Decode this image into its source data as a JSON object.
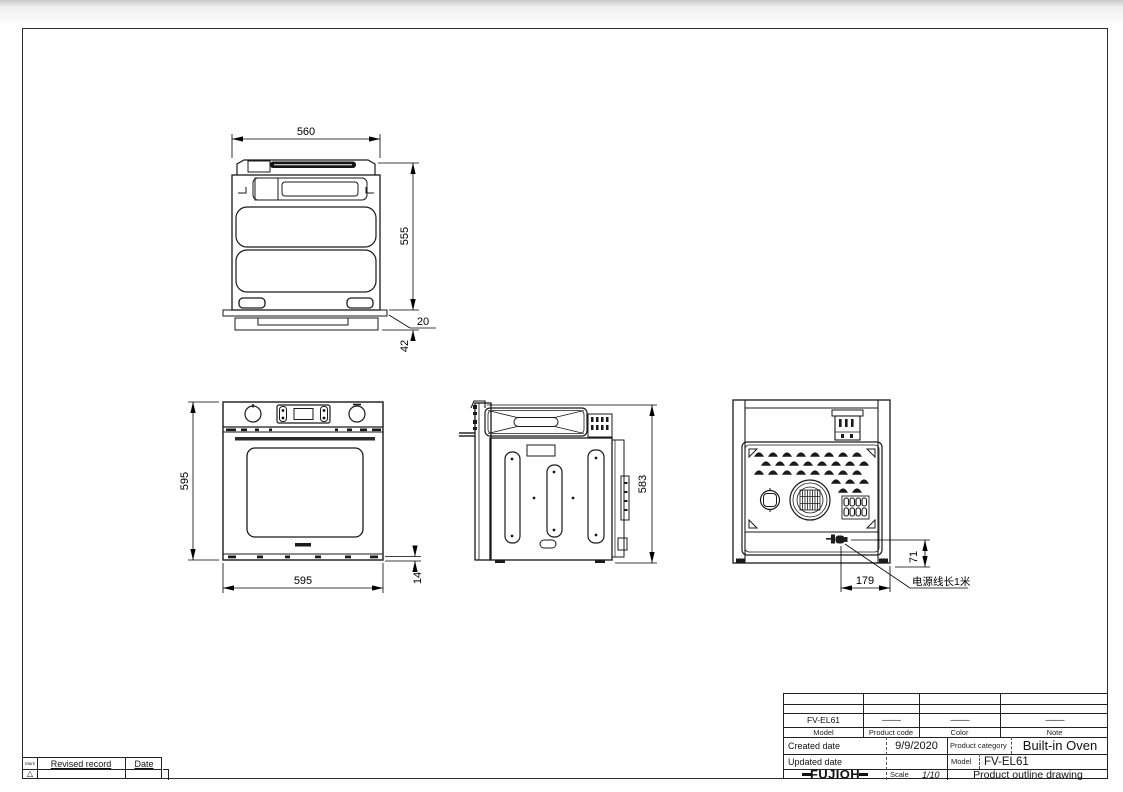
{
  "views": {
    "top": {
      "dim_width": "560",
      "dim_depth": "555",
      "dim_gap": "20",
      "dim_overhang": "42"
    },
    "front": {
      "dim_height": "595",
      "dim_width": "595",
      "dim_trim": "14"
    },
    "side": {
      "dim_depth": "583"
    },
    "back": {
      "dim_cord_offset": "179",
      "dim_cord_height": "71",
      "cord_note": "电源线长1米"
    }
  },
  "revision": {
    "mark_label": "Mark",
    "mark_symbol": "△",
    "record_label": "Revised record",
    "date_label": "Date"
  },
  "title_block": {
    "model_value": "FV-EL61",
    "product_code_value": "——",
    "color_value": "——",
    "note_value": "——",
    "model_label": "Model",
    "product_code_label": "Product code",
    "color_label": "Color",
    "note_label": "Note",
    "created_label": "Created date",
    "created_value": "9/9/2020",
    "category_label": "Product category",
    "category_value": "Built-in Oven",
    "updated_label": "Updated date",
    "updated_value": "",
    "model2_label": "Model",
    "model2_value": "FV-EL61",
    "brand": "FUJIOH",
    "scale_label": "Scale",
    "scale_value": "1/10",
    "drawing_title": "Product outline drawing"
  }
}
